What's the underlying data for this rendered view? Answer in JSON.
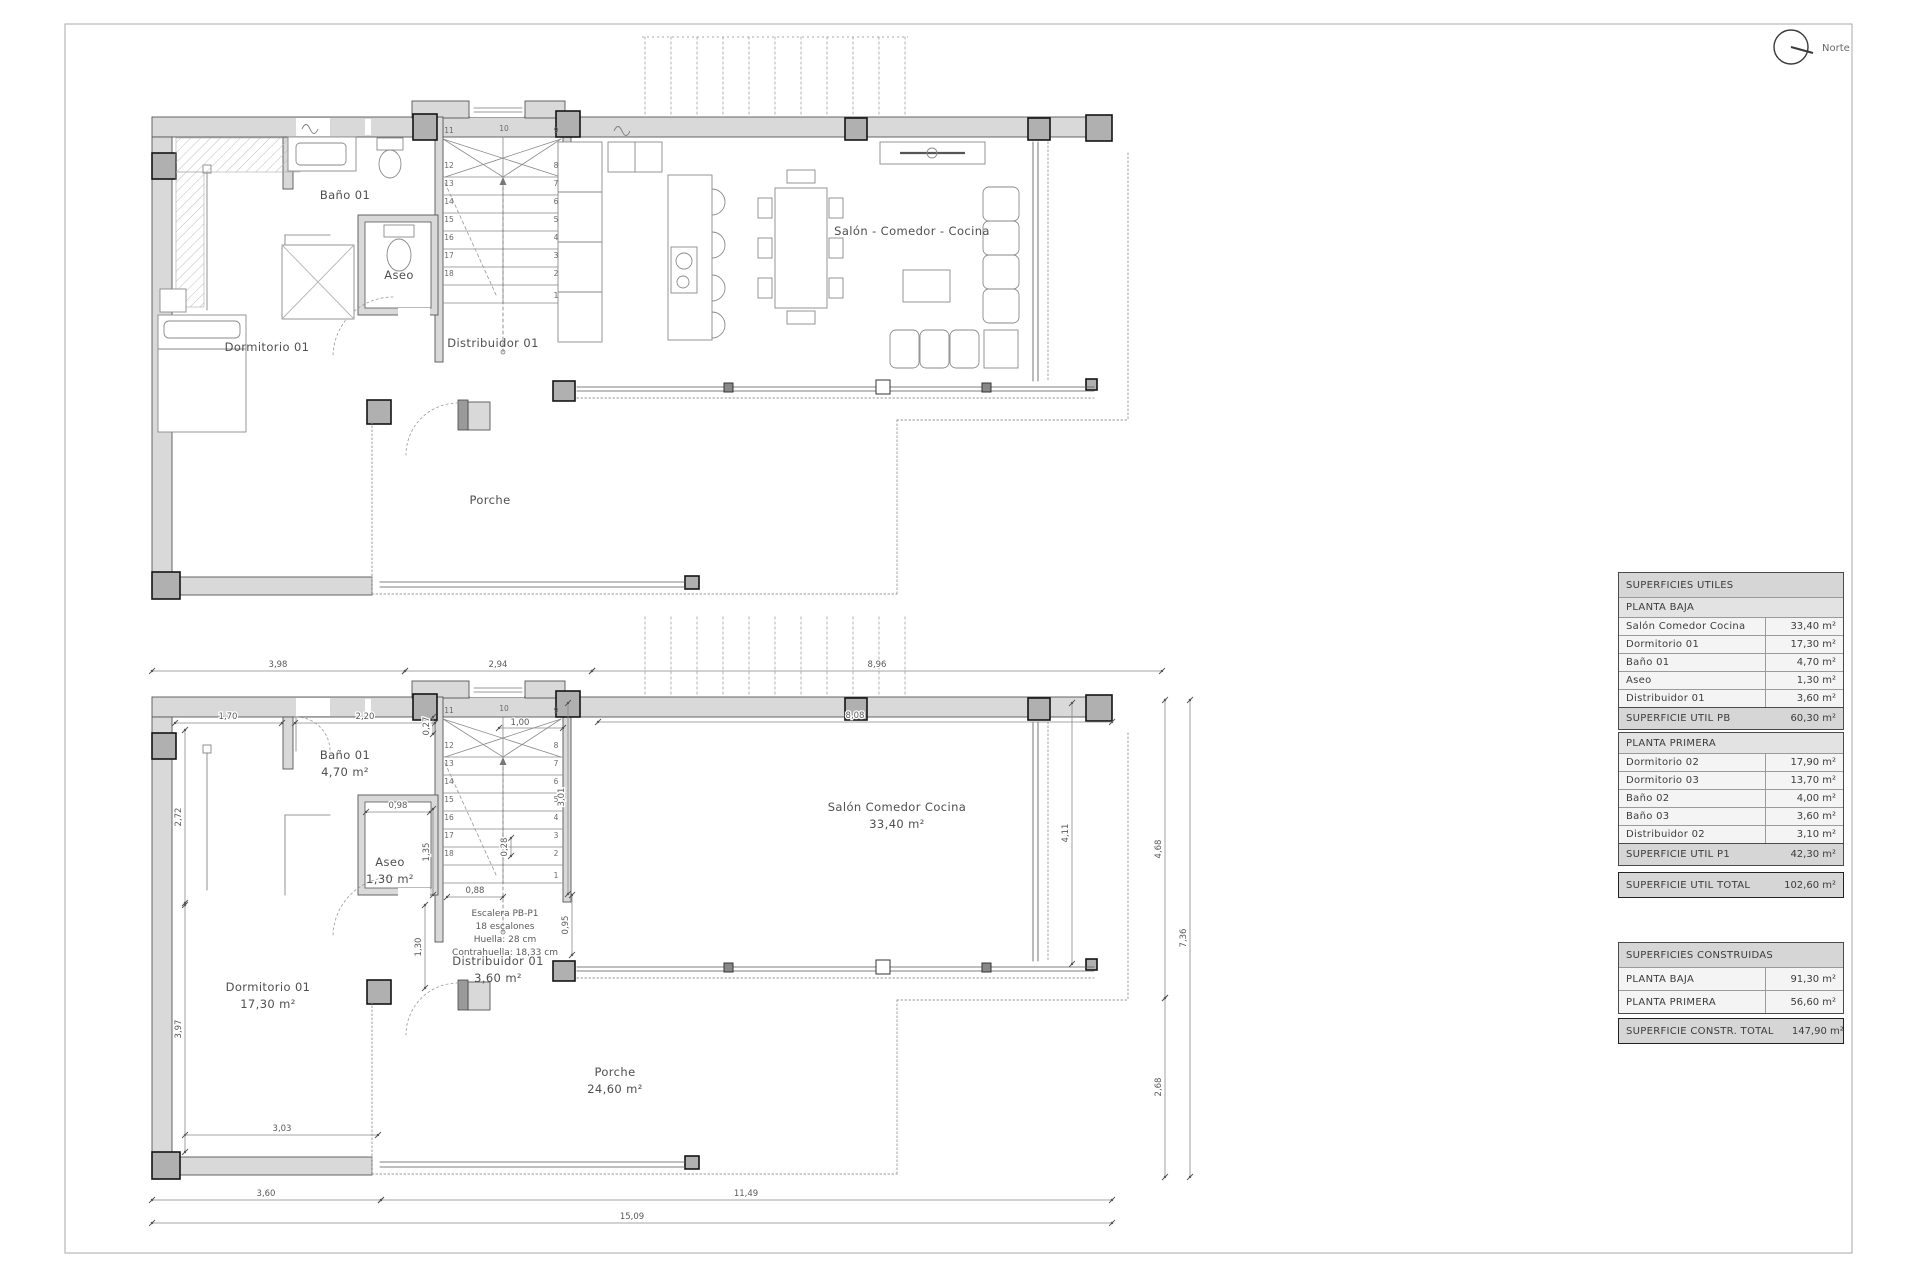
{
  "sheet": {
    "north_label": "Norte",
    "colors": {
      "wall_fill": "#d9d9d9",
      "pier_fill": "#b0b0b0",
      "line": "#555555",
      "dim": "#888888",
      "label_text": "#4f4f4f",
      "table_title_bg": "#d6d6d6",
      "table_sub_bg": "#e3e3e3",
      "table_row_bg": "#f4f4f4",
      "border": "#a9a9a9"
    }
  },
  "plan_upper": {
    "labels": {
      "bano": "Baño 01",
      "aseo": "Aseo",
      "dormitorio": "Dormitorio 01",
      "distribuidor": "Distribuidor 01",
      "salon": "Salón - Comedor - Cocina",
      "porche": "Porche"
    }
  },
  "plan_lower": {
    "labels": {
      "bano": [
        "Baño 01",
        "4,70 m²"
      ],
      "aseo": [
        "Aseo",
        "1,30 m²"
      ],
      "dormitorio": [
        "Dormitorio 01",
        "17,30 m²"
      ],
      "distribuidor": [
        "Distribuidor 01",
        "3,60 m²"
      ],
      "salon": [
        "Salón Comedor Cocina",
        "33,40 m²"
      ],
      "porche": [
        "Porche",
        "24,60 m²"
      ]
    },
    "stair_note": [
      "Escalera PB-P1",
      "18 escalones",
      "Huella: 28 cm",
      "Contrahuella: 18,33 cm"
    ],
    "dimensions": {
      "top": [
        "3,98",
        "2,94",
        "8,96"
      ],
      "bottom": [
        "3,60",
        "11,49",
        "15,09"
      ],
      "inner_h": [
        "1,70",
        "2,20",
        "8,08",
        "1,00",
        "0,98",
        "0,88",
        "3,03"
      ],
      "inner_v": [
        "0,27",
        "2,72",
        "3,97",
        "1,35",
        "0,28",
        "1,30",
        "0,95",
        "3,01",
        "4,11"
      ],
      "right": [
        "4,68",
        "2,68",
        "7,36"
      ]
    }
  },
  "stair_numbers": [
    "1",
    "2",
    "3",
    "4",
    "5",
    "6",
    "7",
    "8",
    "9",
    "10",
    "11",
    "12",
    "13",
    "14",
    "15",
    "16",
    "17",
    "18"
  ],
  "tables": {
    "useful": {
      "title": "SUPERFICIES ÚTILES",
      "sections": [
        {
          "header": "PLANTA BAJA",
          "rows": [
            [
              "Salón Comedor Cocina",
              "33,40 m²"
            ],
            [
              "Dormitorio 01",
              "17,30 m²"
            ],
            [
              "Baño 01",
              "4,70 m²"
            ],
            [
              "Aseo",
              "1,30 m²"
            ],
            [
              "Distribuidor 01",
              "3,60 m²"
            ]
          ],
          "total": [
            "SUPERFICIE ÚTIL PB",
            "60,30 m²"
          ]
        },
        {
          "header": "PLANTA PRIMERA",
          "rows": [
            [
              "Dormitorio 02",
              "17,90 m²"
            ],
            [
              "Dormitorio 03",
              "13,70 m²"
            ],
            [
              "Baño 02",
              "4,00 m²"
            ],
            [
              "Baño 03",
              "3,60 m²"
            ],
            [
              "Distribuidor 02",
              "3,10 m²"
            ]
          ],
          "total": [
            "SUPERFICIE ÚTIL P1",
            "42,30 m²"
          ]
        }
      ],
      "grand_total": [
        "SUPERFICIE ÚTIL TOTAL",
        "102,60 m²"
      ]
    },
    "built": {
      "title": "SUPERFICIES CONSTRUIDAS",
      "rows": [
        [
          "PLANTA BAJA",
          "91,30 m²"
        ],
        [
          "PLANTA PRIMERA",
          "56,60 m²"
        ]
      ],
      "total": [
        "SUPERFICIE CONSTR. TOTAL",
        "147,90 m²"
      ]
    }
  }
}
